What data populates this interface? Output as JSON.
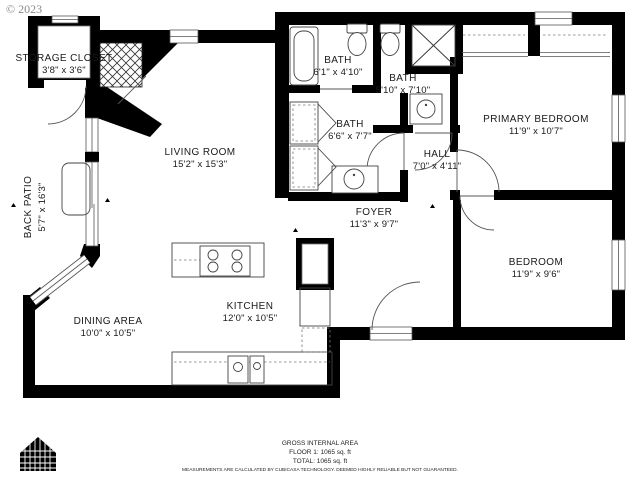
{
  "copyright": "© 2023",
  "plan": {
    "rooms": [
      {
        "id": "storage-closet",
        "name": "STORAGE CLOSET",
        "dims": "3'8\" x 3'6\""
      },
      {
        "id": "bath-top-left",
        "name": "BATH",
        "dims": "6'1\" x 4'10\""
      },
      {
        "id": "bath-top-right",
        "name": "BATH",
        "dims": "5'10\" x 7'10\""
      },
      {
        "id": "primary-bedroom",
        "name": "PRIMARY BEDROOM",
        "dims": "11'9\" x 10'7\""
      },
      {
        "id": "living-room",
        "name": "LIVING ROOM",
        "dims": "15'2\" x 15'3\""
      },
      {
        "id": "back-patio",
        "name": "BACK PATIO",
        "dims": "5'7\" x 16'3\""
      },
      {
        "id": "bath-middle",
        "name": "BATH",
        "dims": "6'6\" x 7'7\""
      },
      {
        "id": "hall",
        "name": "HALL",
        "dims": "7'0\" x 4'11\""
      },
      {
        "id": "foyer",
        "name": "FOYER",
        "dims": "11'3\" x 9'7\""
      },
      {
        "id": "dining-area",
        "name": "DINING AREA",
        "dims": "10'0\" x 10'5\""
      },
      {
        "id": "kitchen",
        "name": "KITCHEN",
        "dims": "12'0\" x 10'5\""
      },
      {
        "id": "bedroom",
        "name": "BEDROOM",
        "dims": "11'9\" x 9'6\""
      }
    ],
    "colors": {
      "wall": "#000000",
      "fixture": "#444444",
      "label": "#1a1a1a",
      "copyright": "#8a8a8a"
    }
  },
  "footer": {
    "area_title": "GROSS INTERNAL AREA",
    "floor_line": "FLOOR 1: 1065 sq. ft",
    "total_line": "TOTAL: 1065 sq. ft",
    "disclaimer": "MEASUREMENTS ARE CALCULATED BY CUBICASA TECHNOLOGY. DEEMED HIGHLY RELIABLE BUT NOT GUARANTEED."
  },
  "logo": {
    "name": "cubicasa-house-logo"
  }
}
